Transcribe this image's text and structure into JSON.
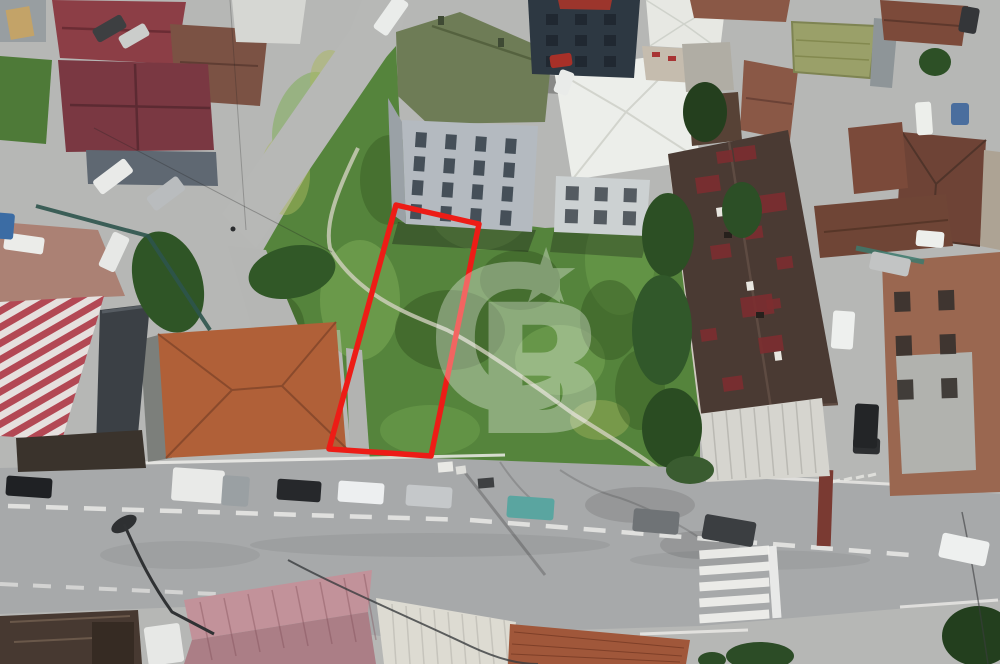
{
  "image": {
    "kind_label": "aerial-drone-photo-of-land-listing",
    "width_px": 1000,
    "height_px": 664
  },
  "watermark": {
    "letter_c": "C",
    "letter_b": "B",
    "star": "★",
    "color": "#ffffff",
    "opacity": 0.32
  },
  "plot_outline": {
    "points": "396,205 479,224 431,456 329,449",
    "color": "#ed1c16",
    "stroke_width": 5.5
  },
  "palette": {
    "grass_base": "#55843c",
    "grass_light": "#7fae58",
    "grass_dark": "#33541f",
    "road_asphalt": "#a7a9aa",
    "base_pavement": "#b6b7b5",
    "parking_gravel": "#ab8174",
    "maroon_roof": "#8c3e46",
    "terracotta_roof": "#b06038",
    "green_apartment_roof": "#6e7c56",
    "white_roof": "#eceeea",
    "navy_building": "#2d3842",
    "big_dark_roof": "#4a3a33",
    "roof_red_patch": "#7c2e30",
    "pink_metal_roof": "#c2929a",
    "striped_roof_red": "#b34854",
    "lane_marking": "#eaeae7"
  },
  "scene": {
    "vehicles": [
      {
        "name": "black-car-parked",
        "x": 6,
        "y": 477,
        "w": 46,
        "h": 20,
        "rot": 4,
        "color": "#1f2124"
      },
      {
        "name": "white-box-truck",
        "x": 172,
        "y": 469,
        "w": 52,
        "h": 33,
        "rot": 4,
        "color": "#e9eae8"
      },
      {
        "name": "truck-cab",
        "x": 222,
        "y": 476,
        "w": 27,
        "h": 30,
        "rot": 4,
        "color": "#9aa0a3"
      },
      {
        "name": "dark-car-parked",
        "x": 277,
        "y": 480,
        "w": 44,
        "h": 21,
        "rot": 4,
        "color": "#26282b"
      },
      {
        "name": "white-car-parked",
        "x": 338,
        "y": 482,
        "w": 46,
        "h": 21,
        "rot": 4,
        "color": "#edeff0"
      },
      {
        "name": "silver-car-parked",
        "x": 406,
        "y": 486,
        "w": 46,
        "h": 21,
        "rot": 4,
        "color": "#c5c8ca"
      },
      {
        "name": "teal-car-parked",
        "x": 507,
        "y": 497,
        "w": 47,
        "h": 22,
        "rot": 4,
        "color": "#5aa5a0"
      },
      {
        "name": "gray-car-road",
        "x": 633,
        "y": 510,
        "w": 46,
        "h": 23,
        "rot": 5,
        "color": "#6f7376"
      },
      {
        "name": "dark-suv-road",
        "x": 703,
        "y": 518,
        "w": 52,
        "h": 25,
        "rot": 10,
        "color": "#3b3e41"
      },
      {
        "name": "white-car-road-right",
        "x": 940,
        "y": 537,
        "w": 48,
        "h": 25,
        "rot": 12,
        "color": "#eef0ef"
      },
      {
        "name": "dark-car-right-junction",
        "x": 853,
        "y": 438,
        "w": 27,
        "h": 16,
        "rot": 2,
        "color": "#2d2f31"
      },
      {
        "name": "white-car-left-street",
        "x": 93,
        "y": 168,
        "w": 40,
        "h": 17,
        "rot": -37,
        "color": "#e9eae8"
      },
      {
        "name": "silver-car-left-street",
        "x": 147,
        "y": 185,
        "w": 38,
        "h": 17,
        "rot": -37,
        "color": "#b9bcbe"
      },
      {
        "name": "dark-car-top-left",
        "x": 93,
        "y": 21,
        "w": 33,
        "h": 15,
        "rot": -30,
        "color": "#3d3f41"
      },
      {
        "name": "white-car-top-left",
        "x": 119,
        "y": 29,
        "w": 30,
        "h": 14,
        "rot": -30,
        "color": "#cbcdcb"
      },
      {
        "name": "white-car-parking",
        "x": 4,
        "y": 235,
        "w": 40,
        "h": 17,
        "rot": 8,
        "color": "#ebece9"
      },
      {
        "name": "white-pickup-parking",
        "x": 95,
        "y": 243,
        "w": 38,
        "h": 18,
        "rot": -65,
        "color": "#e7e8e6"
      },
      {
        "name": "blue-car-edge",
        "x": -6,
        "y": 213,
        "w": 20,
        "h": 26,
        "rot": 5,
        "color": "#3b6ca4"
      },
      {
        "name": "white-car-top-street",
        "x": 371,
        "y": 7,
        "w": 40,
        "h": 17,
        "rot": -55,
        "color": "#eaecea"
      },
      {
        "name": "red-truck-center",
        "x": 550,
        "y": 54,
        "w": 22,
        "h": 13,
        "rot": -8,
        "color": "#a73028"
      },
      {
        "name": "white-van-center",
        "x": 552,
        "y": 75,
        "w": 24,
        "h": 15,
        "rot": -70,
        "color": "#e9ebe9"
      },
      {
        "name": "white-van-right-street",
        "x": 916,
        "y": 231,
        "w": 28,
        "h": 16,
        "rot": 5,
        "color": "#edefec"
      },
      {
        "name": "silver-car-right-street",
        "x": 870,
        "y": 255,
        "w": 40,
        "h": 18,
        "rot": 12,
        "color": "#c2c4c4"
      },
      {
        "name": "white-car-right-street",
        "x": 832,
        "y": 311,
        "w": 22,
        "h": 38,
        "rot": 4,
        "color": "#eef0ee"
      },
      {
        "name": "black-car-right-street",
        "x": 854,
        "y": 404,
        "w": 24,
        "h": 44,
        "rot": 3,
        "color": "#232527"
      },
      {
        "name": "white-van-top-right",
        "x": 916,
        "y": 102,
        "w": 16,
        "h": 33,
        "rot": -4,
        "color": "#edefeb"
      },
      {
        "name": "dark-car-top-right",
        "x": 960,
        "y": 7,
        "w": 18,
        "h": 26,
        "rot": 10,
        "color": "#343639"
      },
      {
        "name": "white-van-bottom",
        "x": 146,
        "y": 625,
        "w": 36,
        "h": 39,
        "rot": -8,
        "color": "#e7e8e6"
      },
      {
        "name": "blue-tarp",
        "x": 951,
        "y": 103,
        "w": 18,
        "h": 22,
        "rot": 0,
        "color": "#4a6e9e"
      }
    ],
    "roof_patches": {
      "rot": -8,
      "color": "#7c2e30",
      "opacity": 0.9,
      "list": [
        [
          695,
          178,
          24,
          16
        ],
        [
          733,
          148,
          22,
          14
        ],
        [
          757,
          196,
          28,
          18
        ],
        [
          710,
          246,
          20,
          14
        ],
        [
          740,
          298,
          32,
          20
        ],
        [
          700,
          330,
          16,
          12
        ],
        [
          758,
          338,
          24,
          16
        ],
        [
          722,
          378,
          20,
          14
        ],
        [
          776,
          258,
          16,
          12
        ],
        [
          744,
          228,
          18,
          12
        ],
        [
          766,
          300,
          14,
          10
        ],
        [
          716,
          152,
          16,
          12
        ]
      ]
    },
    "window_grids": [
      {
        "name": "green-apartment-windows",
        "x": 416,
        "y": 132,
        "cols": 4,
        "rows": 4,
        "dx": 30,
        "dy": 24,
        "w": 11,
        "h": 15,
        "rot": 4,
        "color": "#39444c",
        "opacity": 0.9
      },
      {
        "name": "white-apartment-windows",
        "x": 566,
        "y": 186,
        "cols": 3,
        "rows": 2,
        "dx": 29,
        "dy": 23,
        "w": 13,
        "h": 14,
        "rot": 2,
        "color": "#474e54",
        "opacity": 0.9
      },
      {
        "name": "navy-building-windows",
        "x": 546,
        "y": 14,
        "cols": 3,
        "rows": 3,
        "dx": 29,
        "dy": 21,
        "w": 12,
        "h": 11,
        "rot": 0,
        "color": "#1e262e",
        "opacity": 0.85
      },
      {
        "name": "brick-building-openings",
        "x": 894,
        "y": 292,
        "cols": 2,
        "rows": 3,
        "dx": 44,
        "dy": 44,
        "w": 16,
        "h": 20,
        "rot": -2,
        "color": "#35302c",
        "opacity": 0.9
      }
    ],
    "crosswalk": {
      "x": 699,
      "y": 548,
      "bar_w": 70,
      "bar_h": 9,
      "gap": 16,
      "count": 5,
      "rot": -4,
      "color": "#f1f1ee",
      "opacity": 0.92
    },
    "dash_lines": [
      {
        "name": "center-lane-dashes",
        "pts": [
          [
            8,
            506
          ],
          [
            470,
            520
          ],
          [
            935,
            557
          ]
        ],
        "dash": 22,
        "gap": 16,
        "w": 4.5,
        "color": "#eaeae7",
        "opacity": 0.85
      },
      {
        "name": "left-lower-dashes",
        "pts": [
          [
            0,
            584
          ],
          [
            258,
            596
          ]
        ],
        "dash": 18,
        "gap": 15,
        "w": 4,
        "color": "#e6e6e3",
        "opacity": 0.7
      }
    ]
  }
}
